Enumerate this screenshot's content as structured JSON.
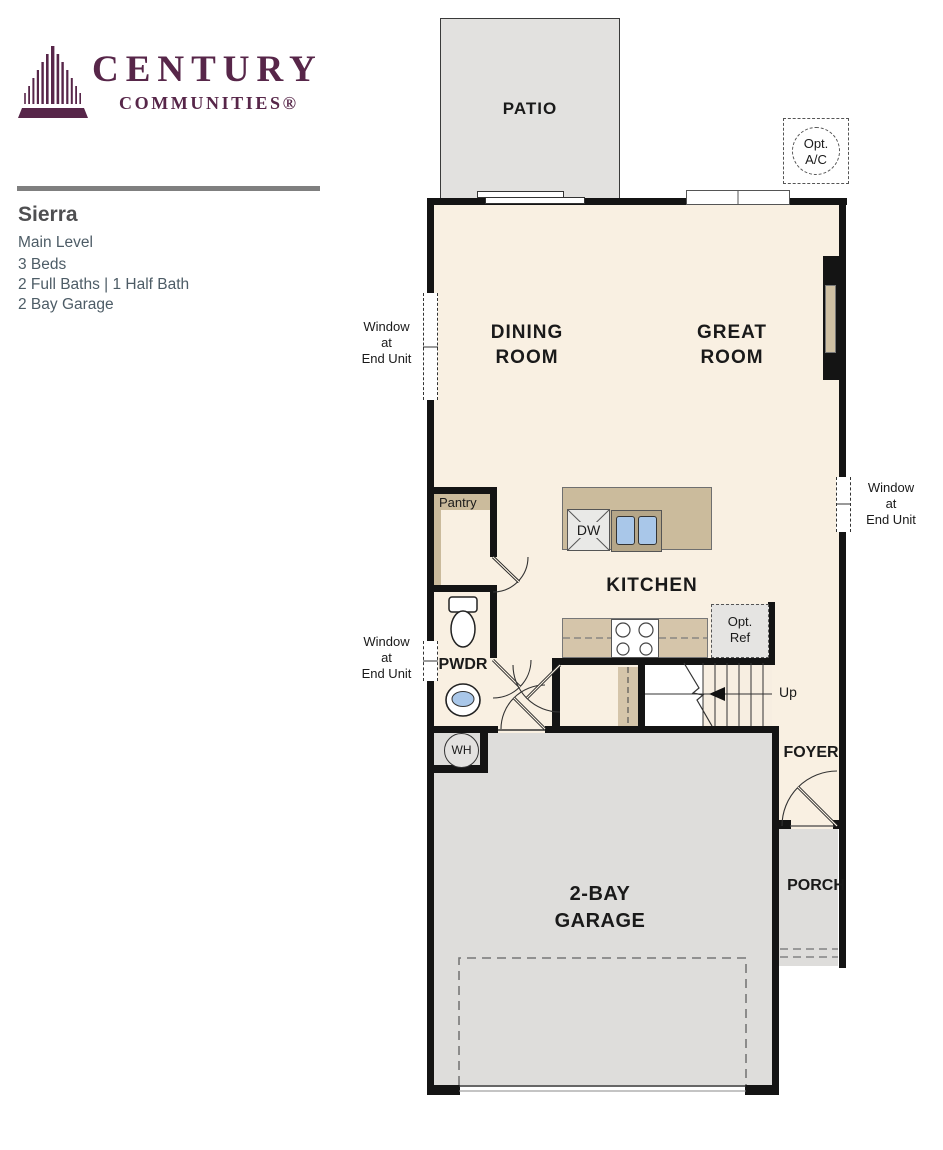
{
  "brand": {
    "name_top": "CENTURY",
    "name_bottom": "COMMUNITIES®",
    "logo_color": "#572649"
  },
  "plan": {
    "name": "Sierra",
    "level": "Main Level",
    "beds": "3 Beds",
    "baths": "2 Full Baths | 1 Half Bath",
    "garage": "2 Bay Garage"
  },
  "floorplan": {
    "patio": "PATIO",
    "dining_line1": "DINING",
    "dining_line2": "ROOM",
    "great_line1": "GREAT",
    "great_line2": "ROOM",
    "kitchen": "KITCHEN",
    "pantry": "Pantry",
    "pwdr": "PWDR",
    "dw": "DW",
    "wh": "WH",
    "up": "Up",
    "foyer": "FOYER",
    "porch": "PORCH",
    "garage_line1": "2-BAY",
    "garage_line2": "GARAGE",
    "opt_ac_line1": "Opt.",
    "opt_ac_line2": "A/C",
    "opt_ref_line1": "Opt.",
    "opt_ref_line2": "Ref",
    "window_note_line1": "Window",
    "window_note_line2": "at",
    "window_note_line3": "End Unit"
  },
  "colors": {
    "interior_cream": "#f9f0e2",
    "patio_gray": "#e2e1df",
    "garage_gray": "#dedddb",
    "cabinet_tan": "#cbbb9c",
    "counter_tan": "#d5c5aa",
    "sink_blue": "#a9c7e9",
    "wall_black": "#141414",
    "divider_gray": "#7f7f7f",
    "heading_gray": "#4f4f51",
    "details_slate": "#4d5c66"
  }
}
